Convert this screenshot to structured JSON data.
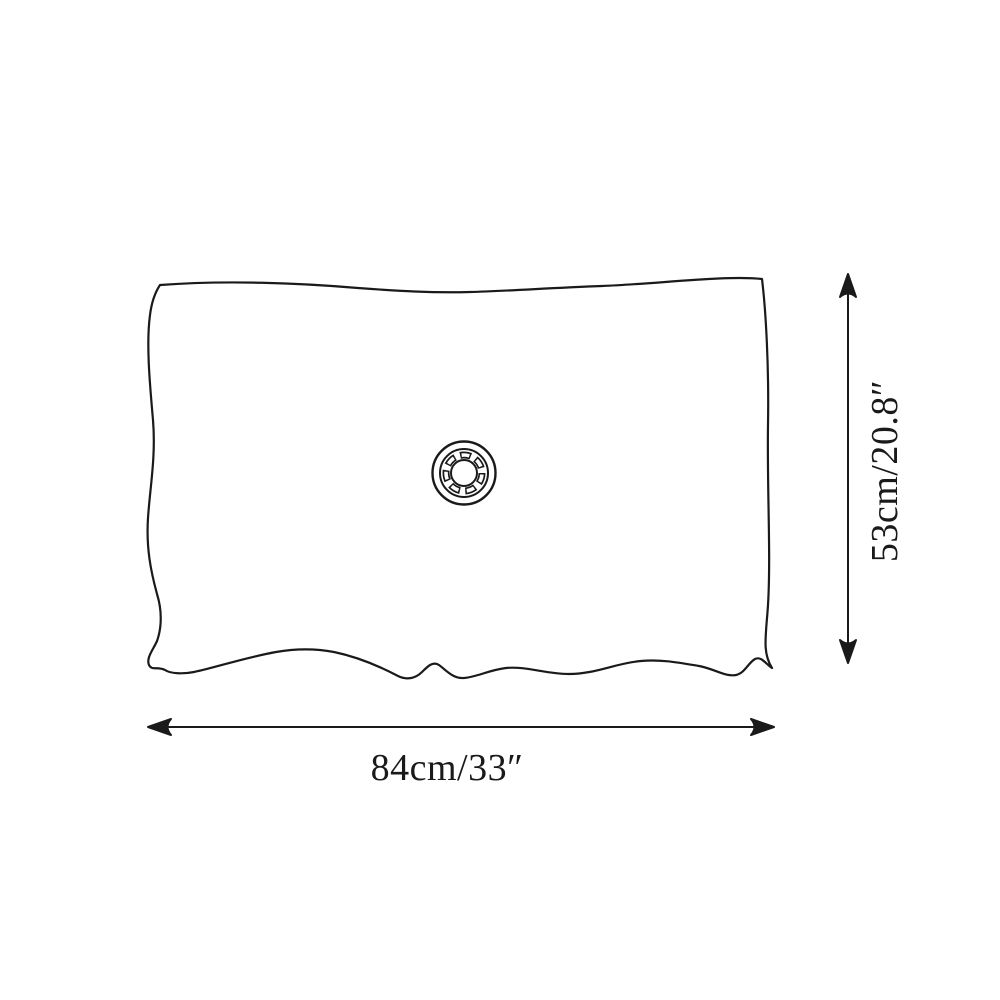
{
  "diagram": {
    "width_label": "84cm/33″",
    "height_label": "53cm/20.8″",
    "line_color": "#1a1a1a",
    "background_color": "#ffffff"
  }
}
